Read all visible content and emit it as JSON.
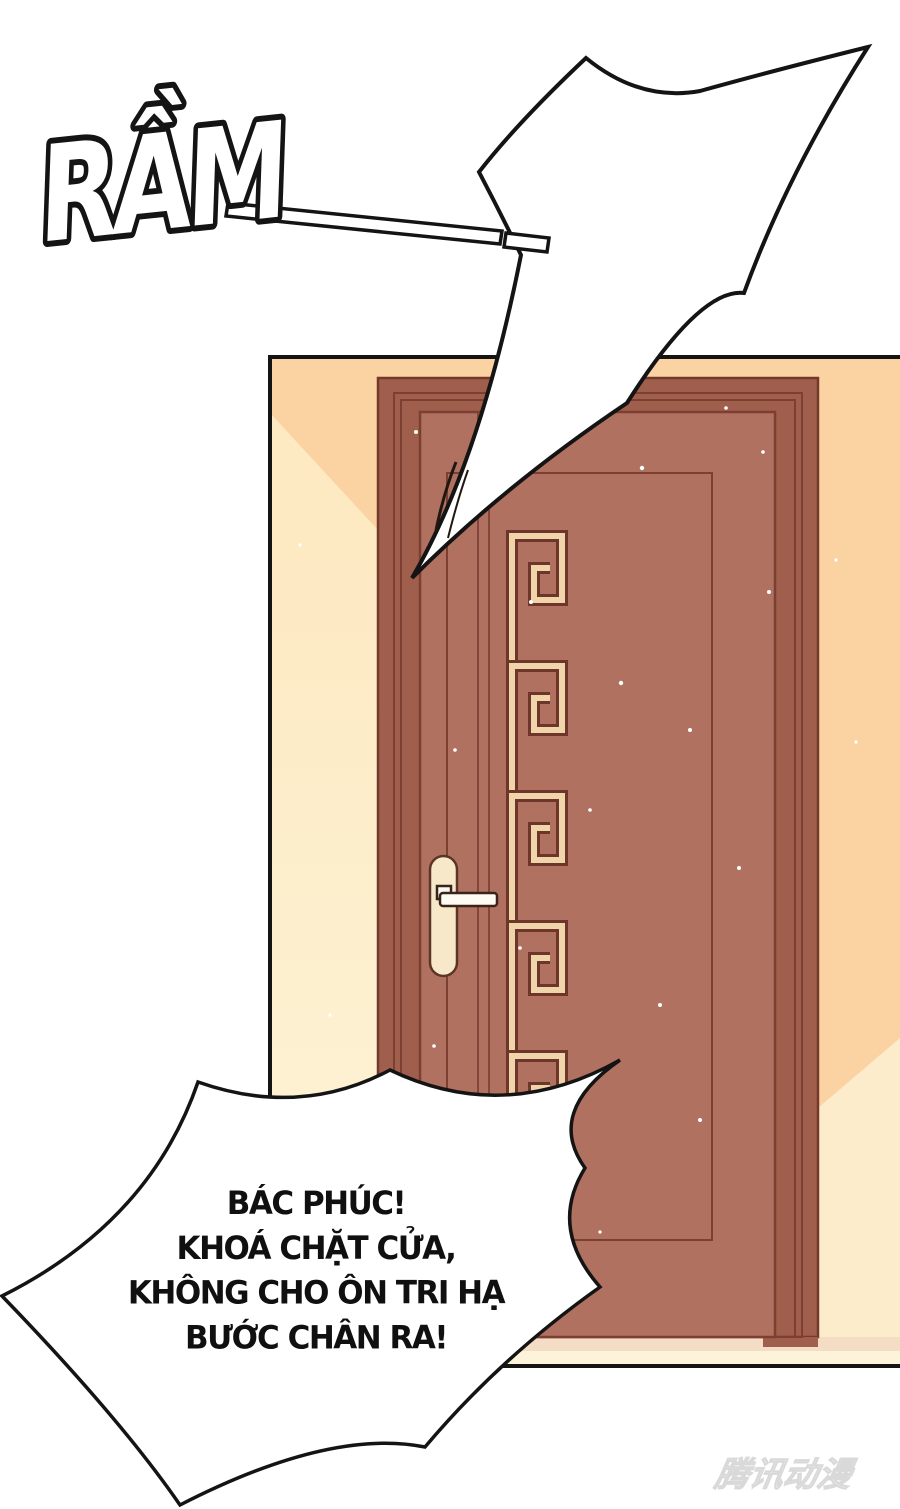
{
  "sfx": {
    "text": "RẦM"
  },
  "speech_bubble": {
    "lines": [
      "BÁC PHÚC!",
      "KHOÁ CHẶT CỬA,",
      "KHÔNG CHO ÔN TRI HẠ",
      "BƯỚC CHÂN RA!"
    ]
  },
  "watermark": {
    "text": "腾讯动漫"
  },
  "colors": {
    "ink": "#141414",
    "wall_base": "#fbd3a2",
    "wall_light_left": "#fdeac3",
    "wall_light_right": "#fdeccb",
    "floor_upper": "#f4dcc5",
    "floor_lower": "#fdf3da",
    "frame": "#a05e4d",
    "frame_line": "#7c4033",
    "door": "#b17161",
    "door_line": "#84463a",
    "meander_dark": "#6e352a",
    "meander_cream": "#f0d5ab",
    "handle_plate": "#f6e8c9",
    "handle_lever": "#fdfbf2",
    "bubble_fill": "#ffffff"
  }
}
